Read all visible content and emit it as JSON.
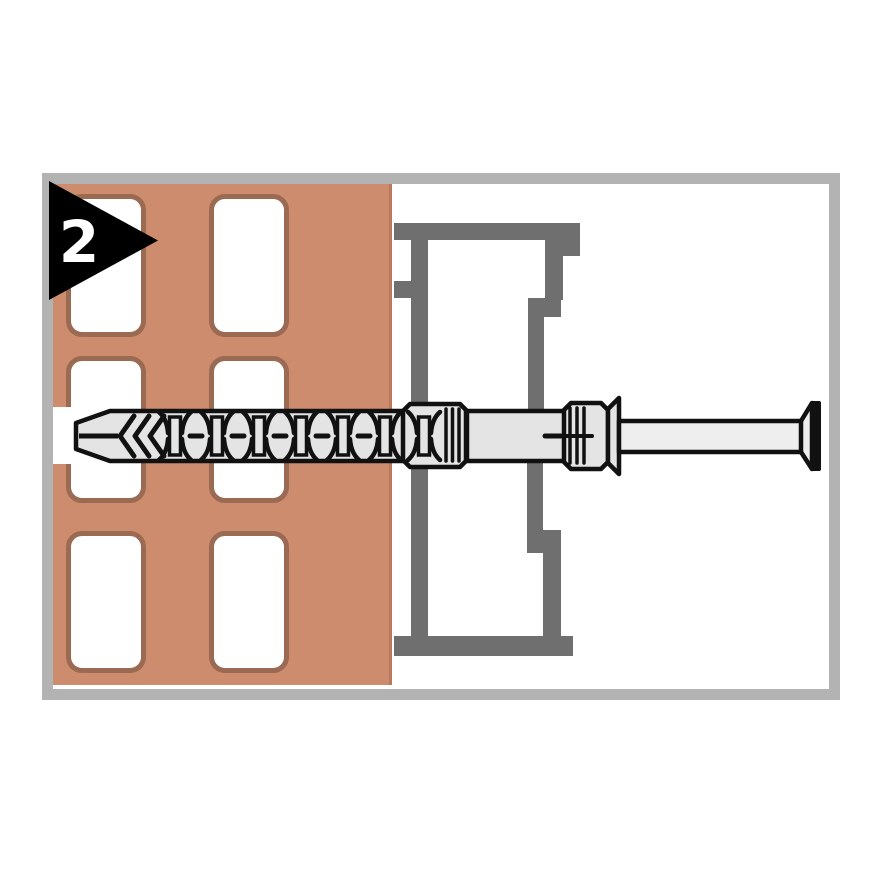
{
  "step_badge": {
    "number": "2"
  },
  "colors": {
    "background": "#ffffff",
    "frame_border": "#b3b3b3",
    "wall": "#cd8c6e",
    "wall_edge": "#b97a5c",
    "hole_outline": "#9a6a52",
    "hole_fill": "#ffffff",
    "profile": "#6f6f6f",
    "anchor_fill": "#e4e4e4",
    "screw_fill": "#eeeeee",
    "outline": "#111111",
    "badge_background": "#000000",
    "badge_number": "#ffffff"
  }
}
